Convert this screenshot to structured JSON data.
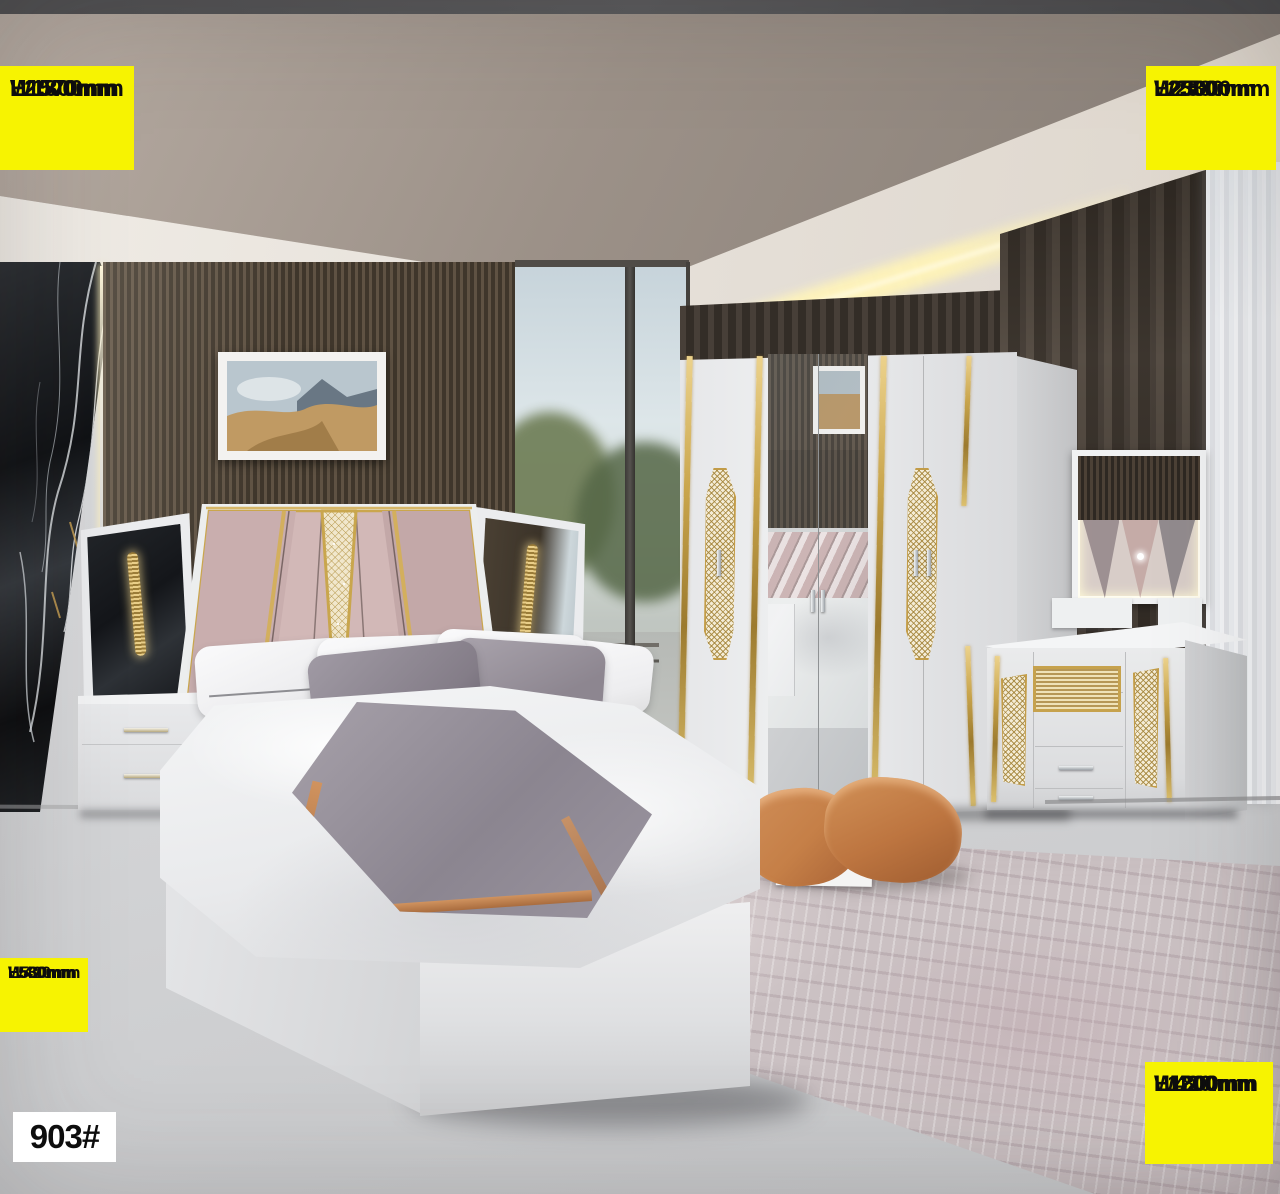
{
  "product": {
    "model_code": "903#"
  },
  "dimension_labels": {
    "top_left": {
      "lines": [
        "L2000mm",
        "W1800mm",
        "H1570mm"
      ]
    },
    "top_right": {
      "lines": [
        "L2580mm",
        "W2580mm",
        "H23000mm"
      ]
    },
    "bottom_left": {
      "lines": [
        "L580mm",
        "W420mm",
        "H530mm"
      ]
    },
    "bottom_right": {
      "lines": [
        "L1200mm",
        "W420mm",
        "H1800mm"
      ]
    }
  },
  "colors": {
    "label_background": "#F7F301",
    "label_text": "#0D0D0D",
    "code_background": "#FFFFFF",
    "code_text": "#0D0D0D",
    "gold_accent": "#C9A64B",
    "floor": "#D4D5D7",
    "rug": "#CBC1C3",
    "slat_wall": "#544839",
    "orange_pillow": "#C57F47"
  }
}
